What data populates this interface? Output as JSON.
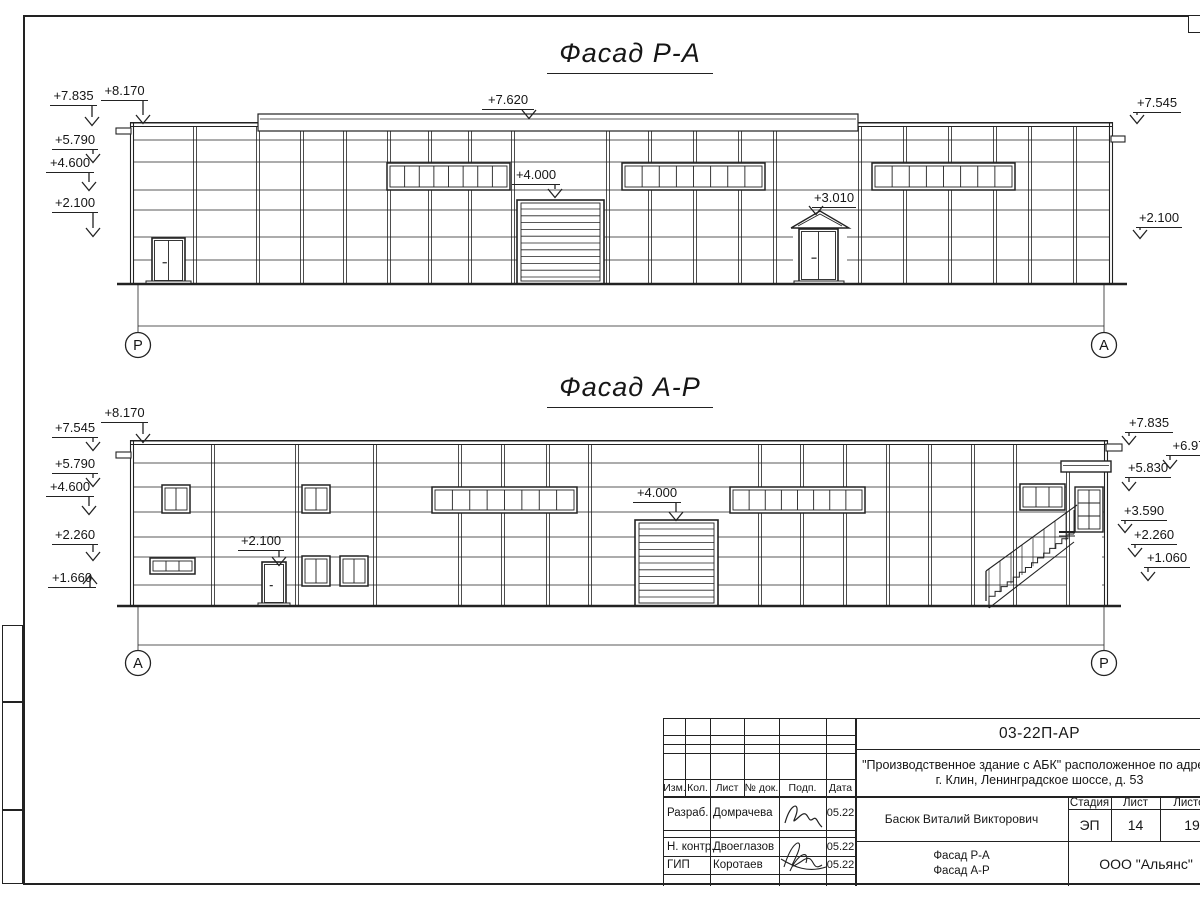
{
  "colors": {
    "line": "#222222",
    "bg": "#ffffff"
  },
  "facade1": {
    "title": "Фасад Р-А",
    "axis_left": "Р",
    "axis_right": "А",
    "marks": [
      {
        "t": "+7.835",
        "x": 50,
        "y": 89,
        "w": 47,
        "s": "r",
        "drop": 20
      },
      {
        "t": "+8.170",
        "x": 101,
        "y": 84,
        "w": 47,
        "s": "r",
        "drop": 23
      },
      {
        "t": "+5.790",
        "x": 52,
        "y": 133,
        "w": 46,
        "s": "r",
        "drop": 13
      },
      {
        "t": "+4.600",
        "x": 46,
        "y": 156,
        "w": 48,
        "s": "r",
        "drop": 18
      },
      {
        "t": "+2.100",
        "x": 52,
        "y": 196,
        "w": 46,
        "s": "r",
        "drop": 24
      },
      {
        "t": "+7.620",
        "x": 482,
        "y": 93,
        "w": 52,
        "s": "r",
        "drop": 9
      },
      {
        "t": "+4.000",
        "x": 512,
        "y": 168,
        "w": 48,
        "s": "r",
        "drop": 13
      },
      {
        "t": "+3.010",
        "x": 812,
        "y": 191,
        "w": 44,
        "s": "l",
        "drop": 7
      },
      {
        "t": "+7.545",
        "x": 1133,
        "y": 96,
        "w": 48,
        "s": "l",
        "drop": 11
      },
      {
        "t": "+2.100",
        "x": 1136,
        "y": 211,
        "w": 46,
        "s": "l",
        "drop": 11
      }
    ]
  },
  "facade2": {
    "title": "Фасад А-Р",
    "axis_left": "А",
    "axis_right": "Р",
    "marks": [
      {
        "t": "+7.545",
        "x": 52,
        "y": 421,
        "w": 46,
        "s": "r",
        "drop": 13
      },
      {
        "t": "+8.170",
        "x": 101,
        "y": 406,
        "w": 47,
        "s": "r",
        "drop": 20
      },
      {
        "t": "+5.790",
        "x": 52,
        "y": 457,
        "w": 46,
        "s": "r",
        "drop": 13
      },
      {
        "t": "+4.600",
        "x": 46,
        "y": 480,
        "w": 48,
        "s": "r",
        "drop": 18
      },
      {
        "t": "+2.260",
        "x": 52,
        "y": 528,
        "w": 46,
        "s": "r",
        "drop": 16
      },
      {
        "t": "+1.660",
        "x": 48,
        "y": 571,
        "w": 48,
        "s": "r",
        "dir": "up",
        "drop": 12
      },
      {
        "t": "+2.100",
        "x": 238,
        "y": 534,
        "w": 46,
        "s": "r",
        "drop": 15
      },
      {
        "t": "+4.000",
        "x": 633,
        "y": 486,
        "w": 48,
        "s": "r",
        "drop": 18
      },
      {
        "t": "+7.835",
        "x": 1125,
        "y": 416,
        "w": 48,
        "s": "l",
        "drop": 12
      },
      {
        "t": "+6.97",
        "x": 1166,
        "y": 439,
        "w": 46,
        "s": "l",
        "drop": 13
      },
      {
        "t": "+5.830",
        "x": 1125,
        "y": 461,
        "w": 46,
        "s": "l",
        "drop": 13
      },
      {
        "t": "+3.590",
        "x": 1121,
        "y": 504,
        "w": 46,
        "s": "l",
        "drop": 12
      },
      {
        "t": "+2.260",
        "x": 1131,
        "y": 528,
        "w": 46,
        "s": "l",
        "drop": 12
      },
      {
        "t": "+1.060",
        "x": 1144,
        "y": 551,
        "w": 46,
        "s": "l",
        "drop": 13
      }
    ]
  },
  "title_block": {
    "doc_number": "03-22П-АР",
    "project_line1": "\"Производственное здание с АБК\" расположенное по адресу",
    "project_line2": "г. Клин, Ленинградское шоссе, д. 53",
    "author": "Басюк Виталий Викторович",
    "sheet_name_line1": "Фасад Р-А",
    "sheet_name_line2": "Фасад А-Р",
    "company": "ООО \"Альянс\"",
    "stage_label": "Стадия",
    "stage_value": "ЭП",
    "list_label": "Лист",
    "list_value": "14",
    "total_label": "Листов",
    "total_value": "19",
    "rev_headers": [
      "Изм.",
      "Кол.",
      "Лист",
      "№ док.",
      "Подп.",
      "Дата"
    ],
    "roles": [
      {
        "role": "Разраб.",
        "name": "Домрачева",
        "date": "05.22"
      },
      {
        "role": "Н. контр.",
        "name": "Двоеглазов",
        "date": "05.22"
      },
      {
        "role": "ГИП",
        "name": "Коротаев",
        "date": "05.22"
      }
    ]
  }
}
